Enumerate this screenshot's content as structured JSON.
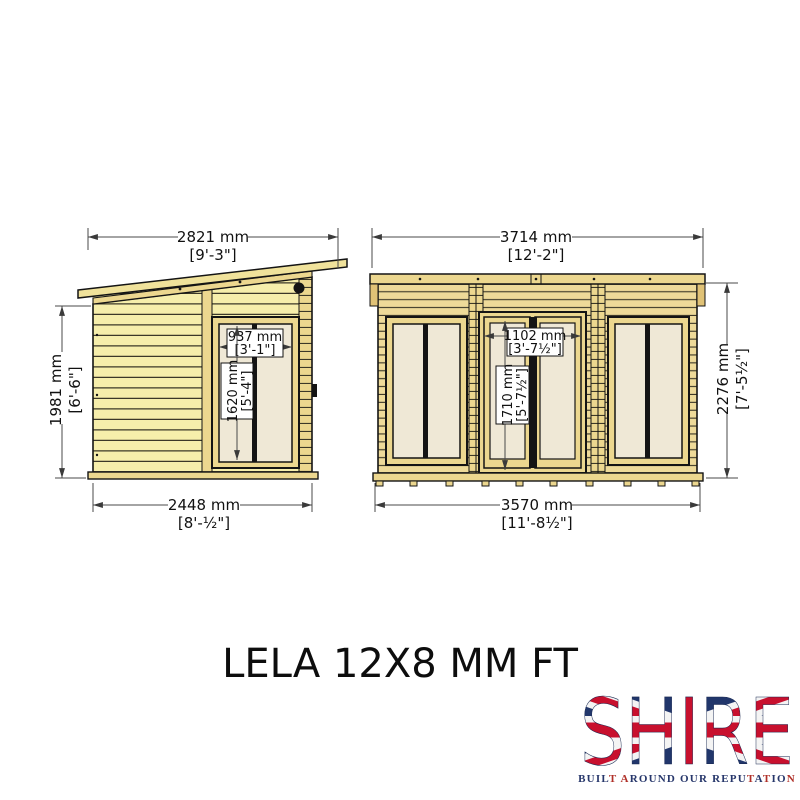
{
  "drawing": {
    "title": "LELA 12X8 MM FT",
    "side_view": {
      "width_top_mm": "2821 mm",
      "width_top_ft": "[9'-3\"]",
      "height_mm": "1981 mm",
      "height_ft": "[6'-6\"]",
      "window_width_mm": "937 mm",
      "window_width_ft": "[3'-1\"]",
      "window_height_mm": "1620 mm",
      "window_height_ft": "[5'-4\"]",
      "width_base_mm": "2448 mm",
      "width_base_ft": "[8'-½\"]"
    },
    "front_view": {
      "width_top_mm": "3714 mm",
      "width_top_ft": "[12'-2\"]",
      "door_width_mm": "1102 mm",
      "door_width_ft": "[3'-7½\"]",
      "door_height_mm": "1710 mm",
      "door_height_ft": "[5'-7½\"]",
      "height_mm": "2276 mm",
      "height_ft": "[7'-5½\"]",
      "width_base_mm": "3570 mm",
      "width_base_ft": "[11'-8½\"]"
    }
  },
  "logo": {
    "brand": "SHIRE",
    "tagline": "BUILT AROUND OUR REPUTATION",
    "tagline_red_indices": [
      4,
      6,
      21,
      23,
      26
    ],
    "colors": {
      "navy": "#27376b",
      "red": "#b03028",
      "flag_blue": "#21366b",
      "flag_red": "#c8102e"
    }
  },
  "colors": {
    "wood_light": "#f6eeab",
    "wood_gold": "#ecd78f",
    "glazing": "#efe8d6",
    "outline": "#141414",
    "dim_line": "#4a4a4a"
  }
}
